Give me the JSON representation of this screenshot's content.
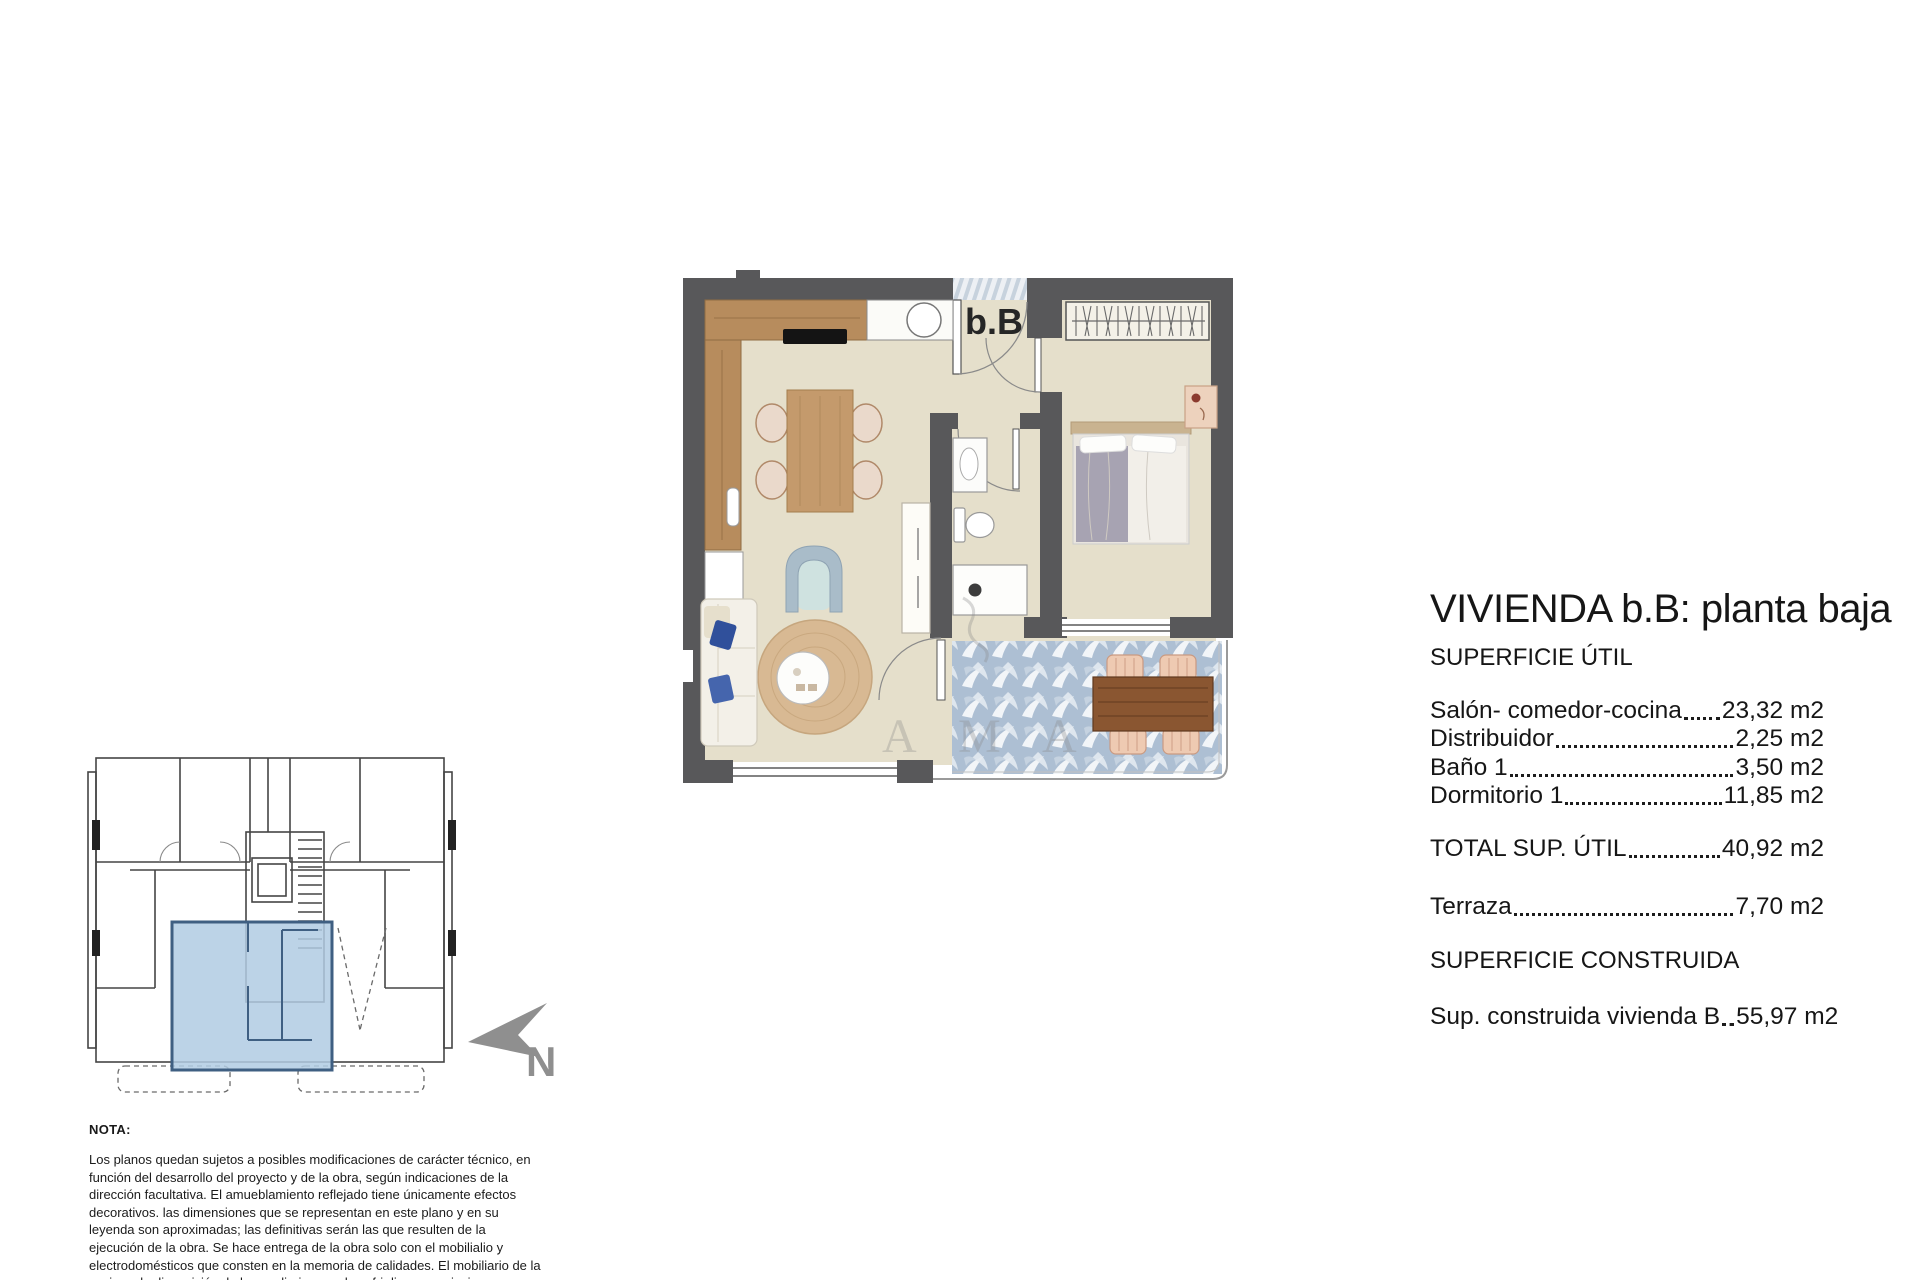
{
  "title": "VIVIENDA b.B: planta baja",
  "areas": {
    "util_header": "SUPERFICIE ÚTIL",
    "rows": [
      {
        "label": "Salón- comedor-cocina",
        "value": "23,32 m2"
      },
      {
        "label": "Distribuidor",
        "value": "2,25 m2"
      },
      {
        "label": "Baño 1",
        "value": "3,50 m2"
      },
      {
        "label": "Dormitorio 1",
        "value": "11,85 m2"
      }
    ],
    "total": {
      "label": "TOTAL SUP. ÚTIL",
      "value": "40,92 m2"
    },
    "terraza": {
      "label": "Terraza",
      "value": "7,70 m2"
    },
    "construida_header": "SUPERFICIE CONSTRUIDA",
    "construida": {
      "label": "Sup. construida vivienda B",
      "value": "55,97 m2"
    }
  },
  "plan": {
    "unit_label": "b.B"
  },
  "compass": {
    "label": "N"
  },
  "watermark": {
    "text": "A M A"
  },
  "note": {
    "heading": "NOTA:",
    "body": "Los planos quedan sujetos a posibles modificaciones de carácter técnico, en función del desarrollo del proyecto y de la obra, según indicaciones de la dirección facultativa. El amueblamiento reflejado tiene únicamente efectos decorativos. las dimensiones que se representan en este plano y en su leyenda son aproximadas; las definitivas serán las que resulten de la ejecución de la obra. Se hace entrega de la obra solo con el mobilialio y electrodomésticos que consten en la memoria de calidades. El mobiliario de la cocina y la disposición de los sanliarios puede sufrir ligeras variaciones en función del montaje definitivo."
  },
  "colors": {
    "wall": "#58585a",
    "floor": "#e5dfcb",
    "terrace_tile": "#adbfd3",
    "unit_highlight": "#b0cbe3",
    "wood": "#b78c5d",
    "compass_gray": "#8f8f8f"
  }
}
